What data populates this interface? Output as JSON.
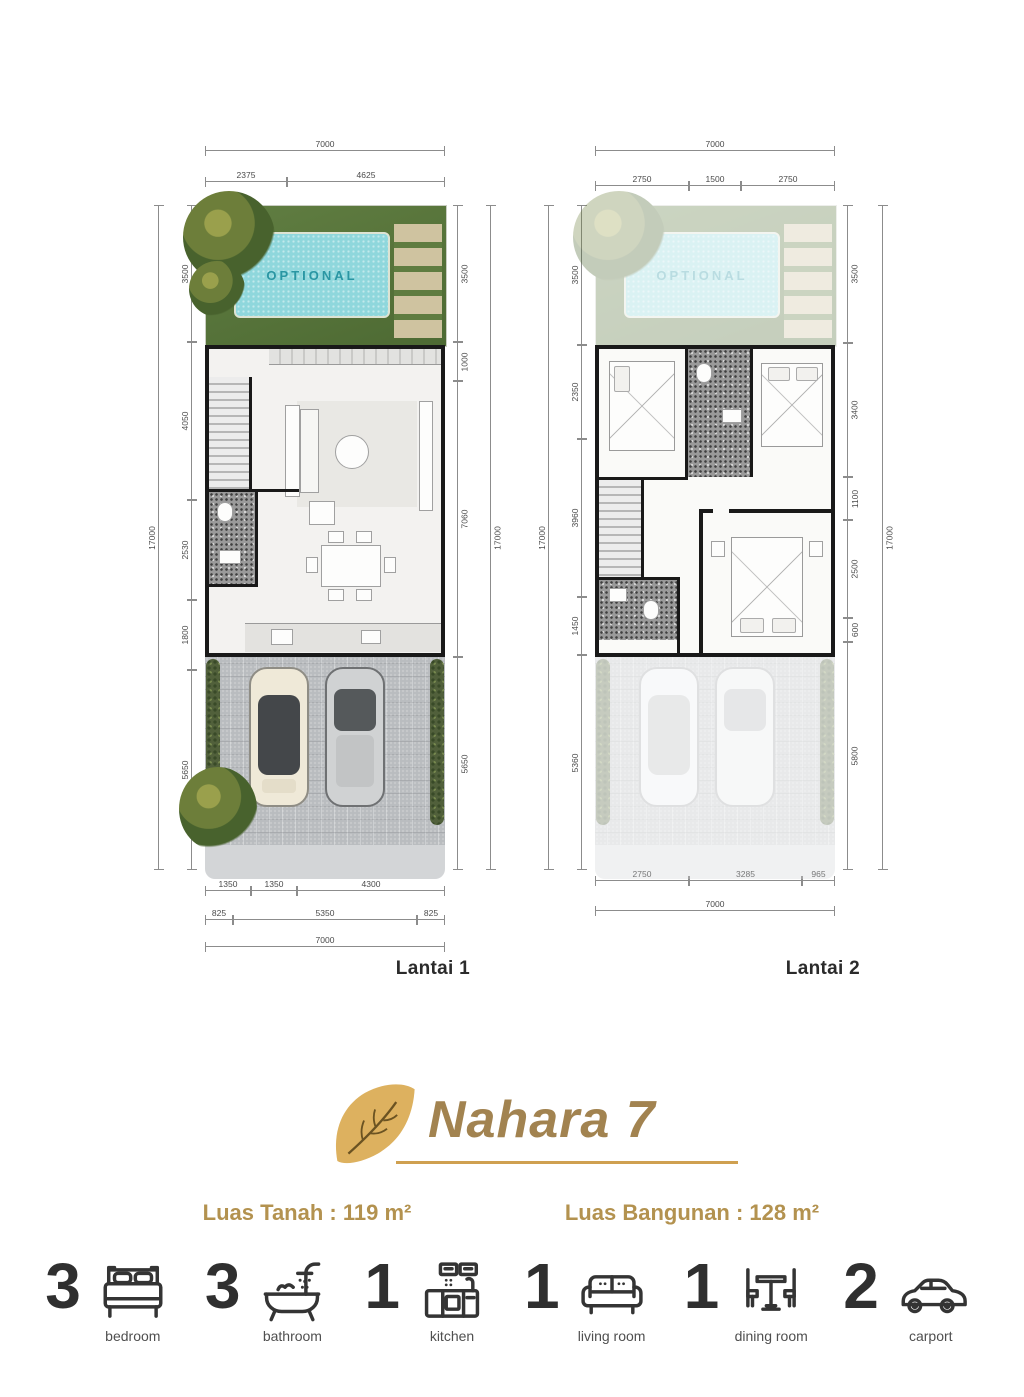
{
  "colors": {
    "gold_leaf": "#ddb15f",
    "title_text": "#a28350",
    "underline": "#cfa050",
    "luas_text": "#b3924f",
    "pool_water": "#8fd7dc",
    "pool_text": "#2a96a3",
    "wall": "#191919",
    "carport_paving": "#b9bcbf"
  },
  "lantai1": {
    "label": "Lantai 1",
    "pool_label": "OPTIONAL",
    "top_total": "7000",
    "top_segments": [
      "2375",
      "4625"
    ],
    "left_total": "17000",
    "left_segments": [
      "3500",
      "4050",
      "2530",
      "1800",
      "5650"
    ],
    "right_total": "17000",
    "right_segments": [
      "3500",
      "1000",
      "7060",
      "5650"
    ],
    "bottom_row1": [
      "1350",
      "1350",
      "4300"
    ],
    "bottom_row2": [
      "825",
      "5350",
      "825"
    ],
    "bottom_total": "7000"
  },
  "lantai2": {
    "label": "Lantai 2",
    "pool_label": "OPTIONAL",
    "top_total": "7000",
    "top_segments": [
      "2750",
      "1500",
      "2750"
    ],
    "left_total": "17000",
    "left_segments": [
      "3500",
      "2350",
      "3960",
      "1450",
      "5360"
    ],
    "right_total": "17000",
    "right_segments": [
      "3500",
      "3400",
      "1100",
      "2500",
      "600",
      "5800"
    ],
    "bottom_row1": [
      "2750",
      "3285",
      "965"
    ],
    "bottom_total": "7000"
  },
  "title": {
    "name": "Nahara 7"
  },
  "areas": {
    "land": "Luas Tanah : 119 m²",
    "building": "Luas Bangunan : 128 m²"
  },
  "legend": {
    "items": [
      {
        "count": "3",
        "label": "bedroom"
      },
      {
        "count": "3",
        "label": "bathroom"
      },
      {
        "count": "1",
        "label": "kitchen"
      },
      {
        "count": "1",
        "label": "living room"
      },
      {
        "count": "1",
        "label": "dining room"
      },
      {
        "count": "2",
        "label": "carport"
      }
    ]
  }
}
